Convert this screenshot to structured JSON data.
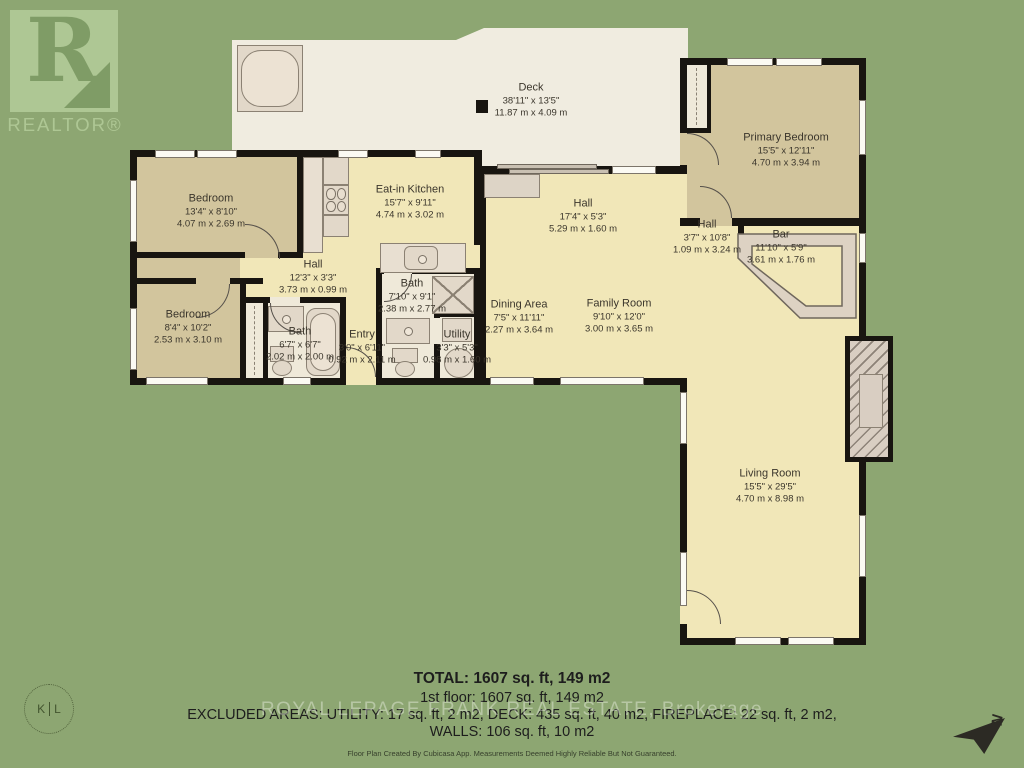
{
  "branding": {
    "realtor_r": "R",
    "realtor_word": "REALTOR®",
    "kl_left": "K",
    "kl_right": "L",
    "watermark": "ROYAL LEPAGE FRANK REAL ESTATE, Brokerage",
    "credit": "Floor Plan Created By Cubicasa App. Measurements Deemed Highly Reliable But Not Guaranteed.",
    "north_letter": "N"
  },
  "summary": {
    "total": "TOTAL: 1607 sq. ft, 149 m2",
    "first_floor": "1st floor: 1607 sq. ft, 149 m2",
    "excluded": "EXCLUDED AREAS: UTILITY: 17 sq. ft, 2 m2, DECK: 435 sq. ft, 40 m2, FIREPLACE: 22 sq. ft, 2 m2,",
    "walls": "WALLS: 106 sq. ft, 10 m2"
  },
  "rooms": [
    {
      "name": "Deck",
      "imperial": "38'11\" x 13'5\"",
      "metric": "11.87 m x 4.09 m"
    },
    {
      "name": "Bedroom",
      "imperial": "13'4\" x 8'10\"",
      "metric": "4.07 m x 2.69 m"
    },
    {
      "name": "Eat-in Kitchen",
      "imperial": "15'7\" x 9'11\"",
      "metric": "4.74 m x 3.02 m"
    },
    {
      "name": "Hall",
      "imperial": "17'4\" x 5'3\"",
      "metric": "5.29 m x 1.60 m"
    },
    {
      "name": "Primary Bedroom",
      "imperial": "15'5\" x 12'11\"",
      "metric": "4.70 m x 3.94 m"
    },
    {
      "name": "Hall",
      "imperial": "12'3\" x 3'3\"",
      "metric": "3.73 m x 0.99 m"
    },
    {
      "name": "Bedroom",
      "imperial": "8'4\" x 10'2\"",
      "metric": "2.53 m x 3.10 m"
    },
    {
      "name": "Bath",
      "imperial": "6'7\" x 6'7\"",
      "metric": "2.02 m x 2.00 m"
    },
    {
      "name": "Bath",
      "imperial": "7'10\" x 9'1\"",
      "metric": "2.38 m x 2.77 m"
    },
    {
      "name": "Entry",
      "imperial": "3'0\" x 6'11\"",
      "metric": "0.92 m x 2.11 m"
    },
    {
      "name": "Utility",
      "imperial": "3'3\" x 5'3\"",
      "metric": "0.98 m x 1.60 m"
    },
    {
      "name": "Dining Area",
      "imperial": "7'5\" x 11'11\"",
      "metric": "2.27 m x 3.64 m"
    },
    {
      "name": "Family Room",
      "imperial": "9'10\" x 12'0\"",
      "metric": "3.00 m x 3.65 m"
    },
    {
      "name": "Hall",
      "imperial": "3'7\" x 10'8\"",
      "metric": "1.09 m x 3.24 m"
    },
    {
      "name": "Bar",
      "imperial": "11'10\" x 5'9\"",
      "metric": "3.61 m x 1.76 m"
    },
    {
      "name": "Living Room",
      "imperial": "15'5\" x 29'5\"",
      "metric": "4.70 m x 8.98 m"
    }
  ],
  "colors": {
    "background": "#8da672",
    "deck": "#f0ece0",
    "room_yellow": "#f1e7b8",
    "room_tan": "#d2c59d",
    "room_cream": "#efe9d9",
    "wall": "#181510",
    "logo_green": "#aec794",
    "logo_dark": "#7f9c66"
  }
}
